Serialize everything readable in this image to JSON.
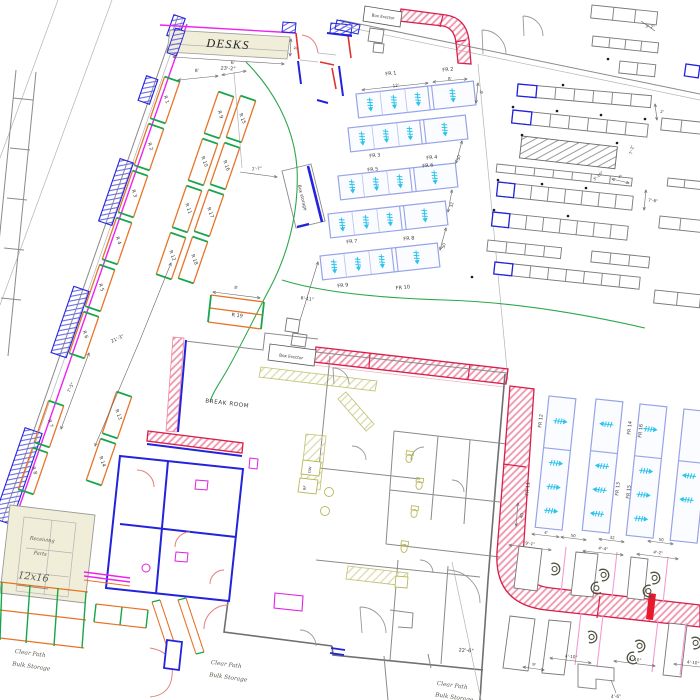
{
  "labels": {
    "desks": "DESKS",
    "break_room": "BREAK ROOM",
    "box_erector_top": "Box Erector",
    "box_erector_mid": "Box Erector",
    "box_storage": "Box storage",
    "receiving_line1": "Receiving",
    "receiving_line2": "Parts",
    "receiving_size": "12x16",
    "dishwasher": "DW",
    "refrigerator": "RF"
  },
  "notes": [
    {
      "l1": "Clear Path",
      "l2": "Bulk Storage"
    },
    {
      "l1": "Clear Path",
      "l2": "Bulk Storage"
    },
    {
      "l1": "Clear Path",
      "l2": "Bulk Storage"
    }
  ],
  "racks": {
    "r": [
      "R 1",
      "R 2",
      "R 3",
      "R 4",
      "R 5",
      "R 6",
      "R 7",
      "R 8",
      "R 9",
      "R 10",
      "R 11",
      "R 12",
      "R 13",
      "R 14",
      "R 15",
      "R 16",
      "R 17",
      "R 18",
      "R 19"
    ],
    "fr": [
      "FR 1",
      "FR 2",
      "FR 3",
      "FR 4",
      "FR 5",
      "FR 6",
      "FR 7",
      "FR 8",
      "FR 9",
      "FR 10",
      "FR 11",
      "FR 12",
      "FR 13",
      "FR 14",
      "FR 15",
      "FR 16"
    ]
  },
  "dims": {
    "desks_len": "23'-2\"",
    "desks_depth": "5'",
    "left_8": "8'",
    "left_6": "6'",
    "storage_2_7": "2'-7\"",
    "aisle_21_3": "21'-3\"",
    "gap_7_5": "7'-5\"",
    "gap_6_11": "6'-11\"",
    "r19_8": "8'",
    "fr_12": "12'",
    "fr_8": "8'",
    "fr_6": "6'",
    "fr_50a": "50",
    "fr_32": "32",
    "fr_50b": "50",
    "tr_3_2": "3'-2\"",
    "tr_2": "2'",
    "tr_7_2": "7'-2\"",
    "tr_3_10": "3'-10\"",
    "tr_3": "3'",
    "tr_7_6": "7'-6\"",
    "fx_40": "40",
    "fx_4": "4'",
    "fx_50a": "50",
    "fx_32": "32",
    "fx_50b": "50",
    "ws_9_1": "9'-1\"",
    "ws_4_4": "4'-4\"",
    "ws_4_2": "4'-2\"",
    "ws_4_10a": "4'-10\"",
    "ws_4_10b": "4'-10\"",
    "ws_4_10c": "4'-10\"",
    "ws_9": "9'",
    "ws_4_6": "4'-6\"",
    "wall_22_6": "22'-6\""
  },
  "colors": {
    "wall_blue": "#2323dd",
    "magenta": "#ee22ee",
    "rack_orange": "#e87328",
    "rack_green": "#17a64a",
    "flow_rack_border": "#97a3e8",
    "flow_arrow_cyan": "#2cc4ea",
    "conveyor_red": "#d81f4a",
    "conveyor_pink_hatch": "#f096ae",
    "beige_fill": "#f0eed8",
    "fixture_olive": "#b9b95a",
    "wall_gray": "#8a8a8a",
    "clear_path_green": "#2ba84a",
    "pink_guide": "#f49ad2"
  }
}
